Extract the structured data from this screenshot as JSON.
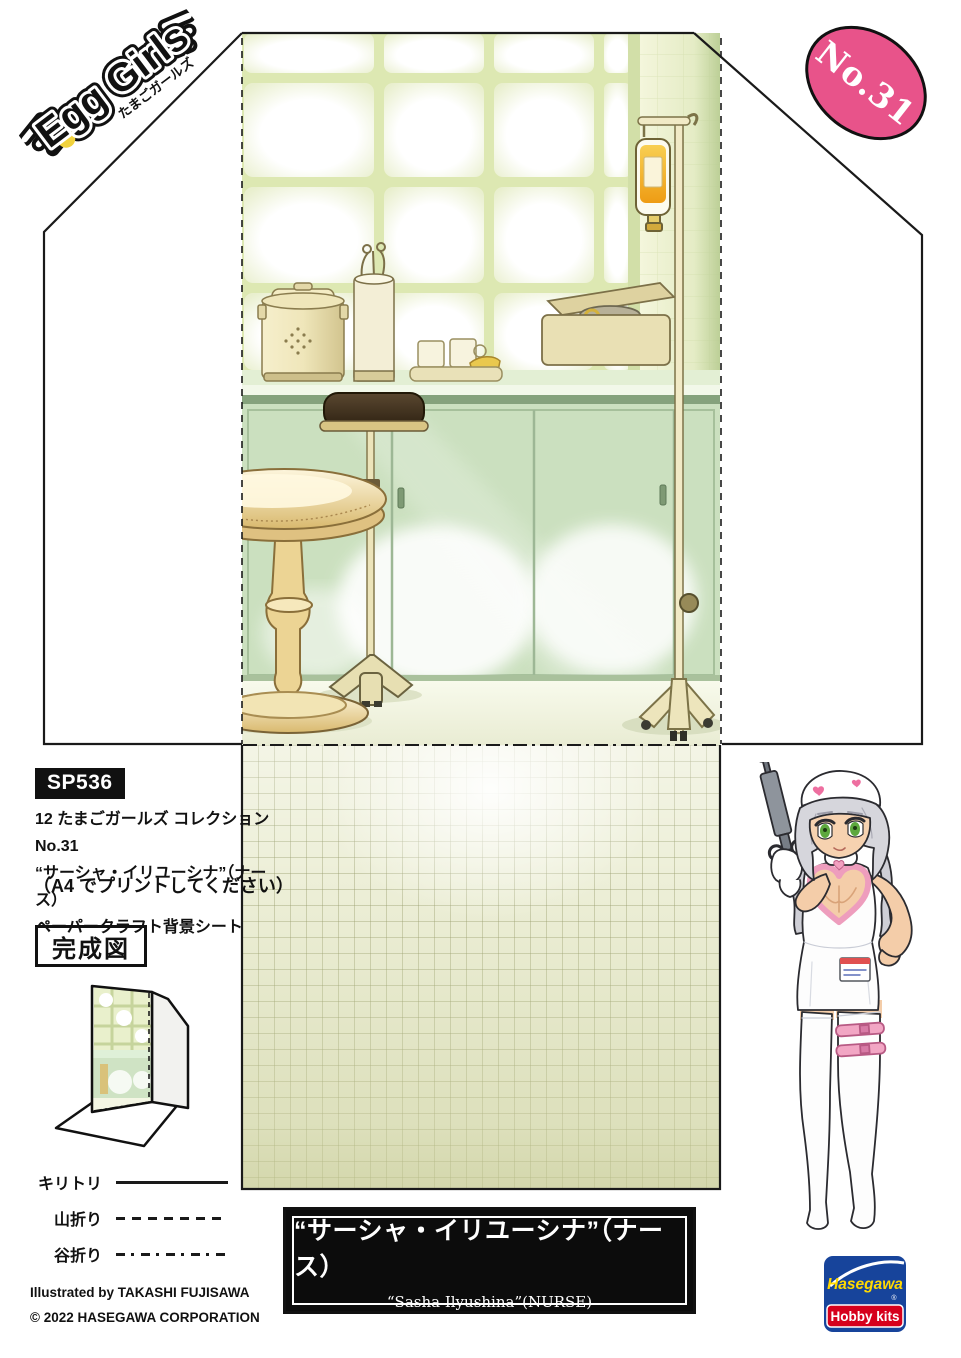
{
  "brand": {
    "name": "Egg Girls",
    "name_jp": "たまごガールズ"
  },
  "badge": {
    "number": "No.31"
  },
  "info": {
    "code": "SP536",
    "line1": "12 たまごガールズ コレクション No.31",
    "line2": "“サーシャ・イリユーシナ”（ナース）",
    "line3": "ペーパークラフト背景シート",
    "print_note": "（A4 でプリントしてください）"
  },
  "completed_figure": {
    "label": "完成図"
  },
  "legend": {
    "cut": "キリトリ",
    "mountain_fold": "山折り",
    "valley_fold": "谷折り"
  },
  "credits": {
    "illustrator": "Illustrated by TAKASHI FUJISAWA",
    "copyright": "© 2022 HASEGAWA CORPORATION"
  },
  "title_box": {
    "title_jp": "“サーシャ・イリユーシナ”（ナース）",
    "title_en": "“Sasha Ilyushina”(NURSE)"
  },
  "publisher": {
    "brand": "Hasegawa",
    "product_line": "Hobby kits",
    "registered_mark": "®"
  },
  "colors": {
    "badge_pink": "#e8538a",
    "dot_separator": "#c14f6e",
    "scene_green": "#cbe0bf",
    "window_frame_green": "#dde8b2",
    "iv_amber": "#f0a93c",
    "stool_tan": "#e4c988",
    "accent_heart_pink": "#ee9dbd",
    "hasegawa_blue": "#17449b",
    "hasegawa_red": "#d6001c",
    "hasegawa_yellow": "#ffd900",
    "line_black": "#1a1a1a"
  }
}
